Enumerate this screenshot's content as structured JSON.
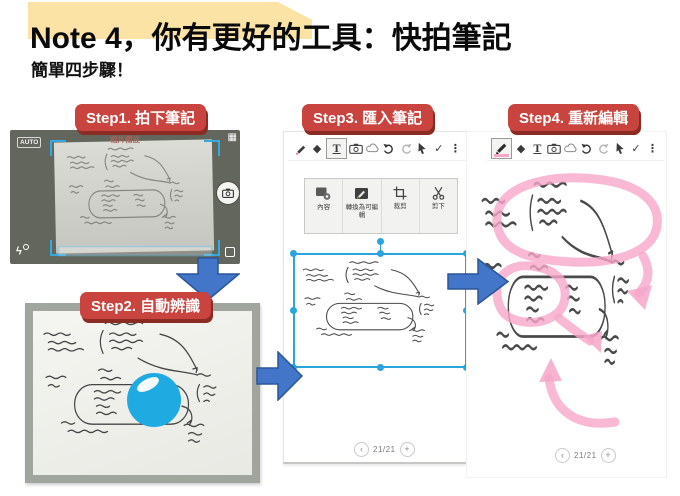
{
  "slide": {
    "title_prefix": "Note 4，你有更好的工具：",
    "title_emphasis": "快拍筆記",
    "subtitle": "簡單四步驟！"
  },
  "steps": [
    {
      "label": "Step1. 拍下筆記"
    },
    {
      "label": "Step2. 自動辨識"
    },
    {
      "label": "Step3. 匯入筆記"
    },
    {
      "label": "Step4. 重新編輯"
    }
  ],
  "camera": {
    "mode": "AUTO",
    "title": "相片備註",
    "grid_glyph": "▦",
    "flash_glyph": "ϟ"
  },
  "toolbar": {
    "eraser_glyph": "◆",
    "text_glyph": "T",
    "check_glyph": "✓",
    "more_glyph": "⋮"
  },
  "menu": {
    "items": [
      {
        "label": "內容"
      },
      {
        "label": "轉換為可編輯"
      },
      {
        "label": "裁剪"
      },
      {
        "label": "剪下"
      }
    ]
  },
  "pager": {
    "prev": "‹",
    "label": "21/21",
    "plus": "+"
  },
  "colors": {
    "step_label_bg": "#C9443E",
    "step_label_shadow": "#8A2B24",
    "arrow_blue": "#4375C8",
    "arrow_blue_dark": "#2A5697",
    "highlight_yellow": "#FBE3A6",
    "annotation_pink": "#F7A6C9",
    "selection_blue": "#2BA3DC",
    "camera_bg": "#63665C",
    "photo_frame": "#A0A69E",
    "ball_blue": "#1FAAE2"
  }
}
